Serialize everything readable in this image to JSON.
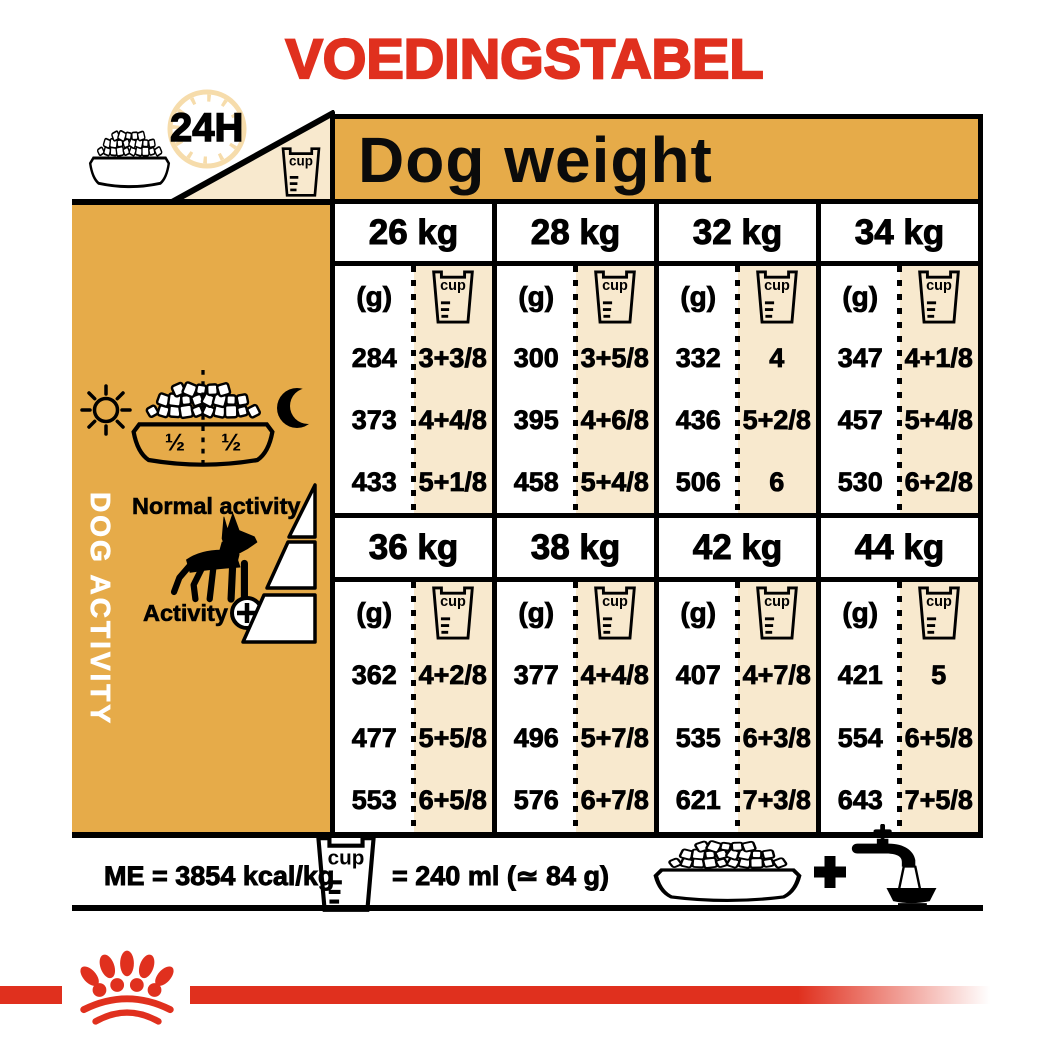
{
  "title": "VOEDINGSTABEL",
  "header": {
    "daily_ration_label": "24H",
    "dog_weight_label": "Dog weight",
    "icons": [
      "food-bowl-icon",
      "clock-icon",
      "measuring-cup-icon"
    ]
  },
  "sidebar": {
    "vertical_label": "DOG ACTIVITY",
    "bowl_left_fraction": "½",
    "bowl_right_fraction": "½",
    "normal_activity_label": "Normal activity",
    "activity_label": "Activity",
    "icons": [
      "sun-icon",
      "moon-icon",
      "half-half-bowl-icon",
      "dog-silhouette-icon",
      "plus-circle-icon",
      "activity-steps-icon"
    ]
  },
  "table": {
    "grams_unit_label": "(g)",
    "cup_label": "cup",
    "bands": [
      {
        "columns": [
          {
            "weight": "26 kg",
            "grams": [
              "284",
              "373",
              "433"
            ],
            "cups": [
              "3+3/8",
              "4+4/8",
              "5+1/8"
            ]
          },
          {
            "weight": "28 kg",
            "grams": [
              "300",
              "395",
              "458"
            ],
            "cups": [
              "3+5/8",
              "4+6/8",
              "5+4/8"
            ]
          },
          {
            "weight": "32 kg",
            "grams": [
              "332",
              "436",
              "506"
            ],
            "cups": [
              "4",
              "5+2/8",
              "6"
            ]
          },
          {
            "weight": "34 kg",
            "grams": [
              "347",
              "457",
              "530"
            ],
            "cups": [
              "4+1/8",
              "5+4/8",
              "6+2/8"
            ]
          }
        ]
      },
      {
        "columns": [
          {
            "weight": "36 kg",
            "grams": [
              "362",
              "477",
              "553"
            ],
            "cups": [
              "4+2/8",
              "5+5/8",
              "6+5/8"
            ]
          },
          {
            "weight": "38 kg",
            "grams": [
              "377",
              "496",
              "576"
            ],
            "cups": [
              "4+4/8",
              "5+7/8",
              "6+7/8"
            ]
          },
          {
            "weight": "42 kg",
            "grams": [
              "407",
              "535",
              "621"
            ],
            "cups": [
              "4+7/8",
              "6+3/8",
              "7+3/8"
            ]
          },
          {
            "weight": "44 kg",
            "grams": [
              "421",
              "554",
              "643"
            ],
            "cups": [
              "5",
              "6+5/8",
              "7+5/8"
            ]
          }
        ]
      }
    ]
  },
  "footer": {
    "energy_label": "ME = 3854 kcal/kg",
    "cup_equivalence_label": "= 240 ml (≃ 84 g)",
    "plus_label": "+",
    "icons": [
      "measuring-cup-icon",
      "food-bowl-icon",
      "plus-icon",
      "water-tap-icon"
    ]
  },
  "brand": {
    "logo": "royal-canin-crown-logo"
  },
  "colors": {
    "brand_red": "#E0301E",
    "accent_orange": "#E6AB49",
    "cream": "#F8E9CE",
    "clock_pale": "#F6DCAB"
  }
}
